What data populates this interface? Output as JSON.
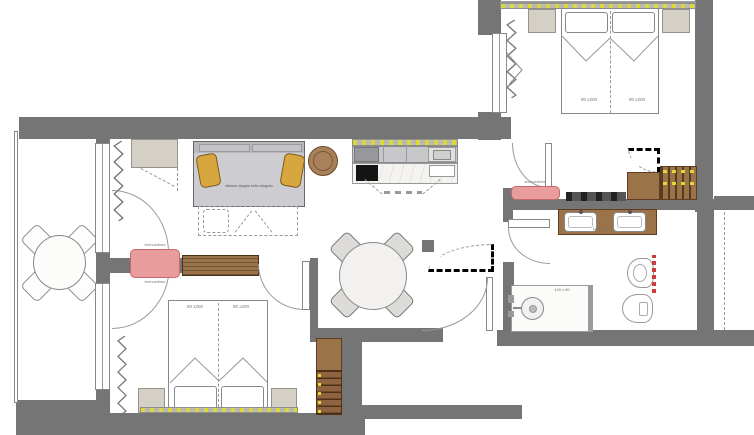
{
  "plan": {
    "type": "apartment-floor-plan",
    "labels": {
      "sofa": "divano doppio letto singolo",
      "bed_bottom": [
        "90 x200",
        "90 x200"
      ],
      "bed_top": [
        "90 x200",
        "90 x200"
      ],
      "radiator_top": "termosifone",
      "radiator_bottom": "termosifone",
      "radiator_hall": "termosifone",
      "shower_size": "140 x 80",
      "vanity_size": "140 x 46"
    },
    "colors": {
      "wall": "#757575",
      "wood": "#9b7348",
      "beige": "#d5d0c6",
      "sofa_gray": "#cdcdd1",
      "pillow_yellow": "#d8a63e",
      "radiator_pink": "#e89c9c",
      "led_yellow": "#ddd935",
      "cooktop_black": "#141414",
      "towel_red": "#cf3a3a"
    }
  }
}
